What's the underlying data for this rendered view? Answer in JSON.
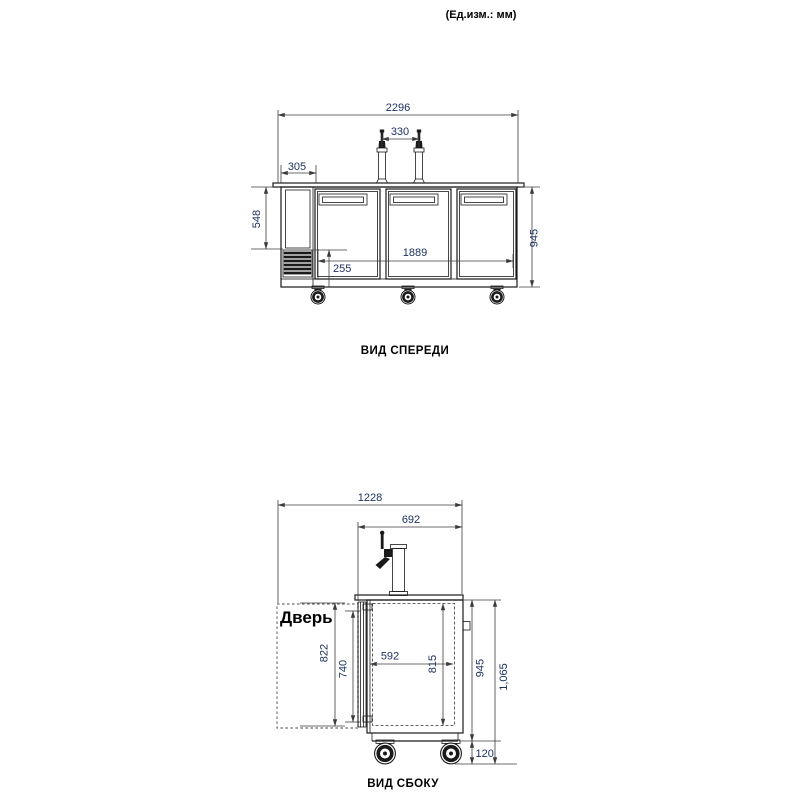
{
  "note_units": "(Ед.изм.: мм)",
  "colors": {
    "line": "#1a1a1a",
    "dim_line": "#3c3c3c",
    "dim_text": "#1d3260",
    "label_text": "#000000"
  },
  "front_view": {
    "title": "ВИД СПЕРЕДИ",
    "dims": {
      "overall_width": "2296",
      "tap_spacing": "330",
      "left_section_width": "305",
      "left_section_height": "548",
      "body_height": "945",
      "doors_width": "1889",
      "grille_height": "255"
    }
  },
  "side_view": {
    "title": "ВИД СБОКУ",
    "door_label": "Дверь",
    "dims": {
      "overall_depth": "1228",
      "tap_to_back": "692",
      "door_height": "822",
      "door_inner_height": "740",
      "interior_depth": "592",
      "interior_height": "815",
      "body_height": "945",
      "overall_height": "1,065",
      "caster_height": "120"
    }
  }
}
